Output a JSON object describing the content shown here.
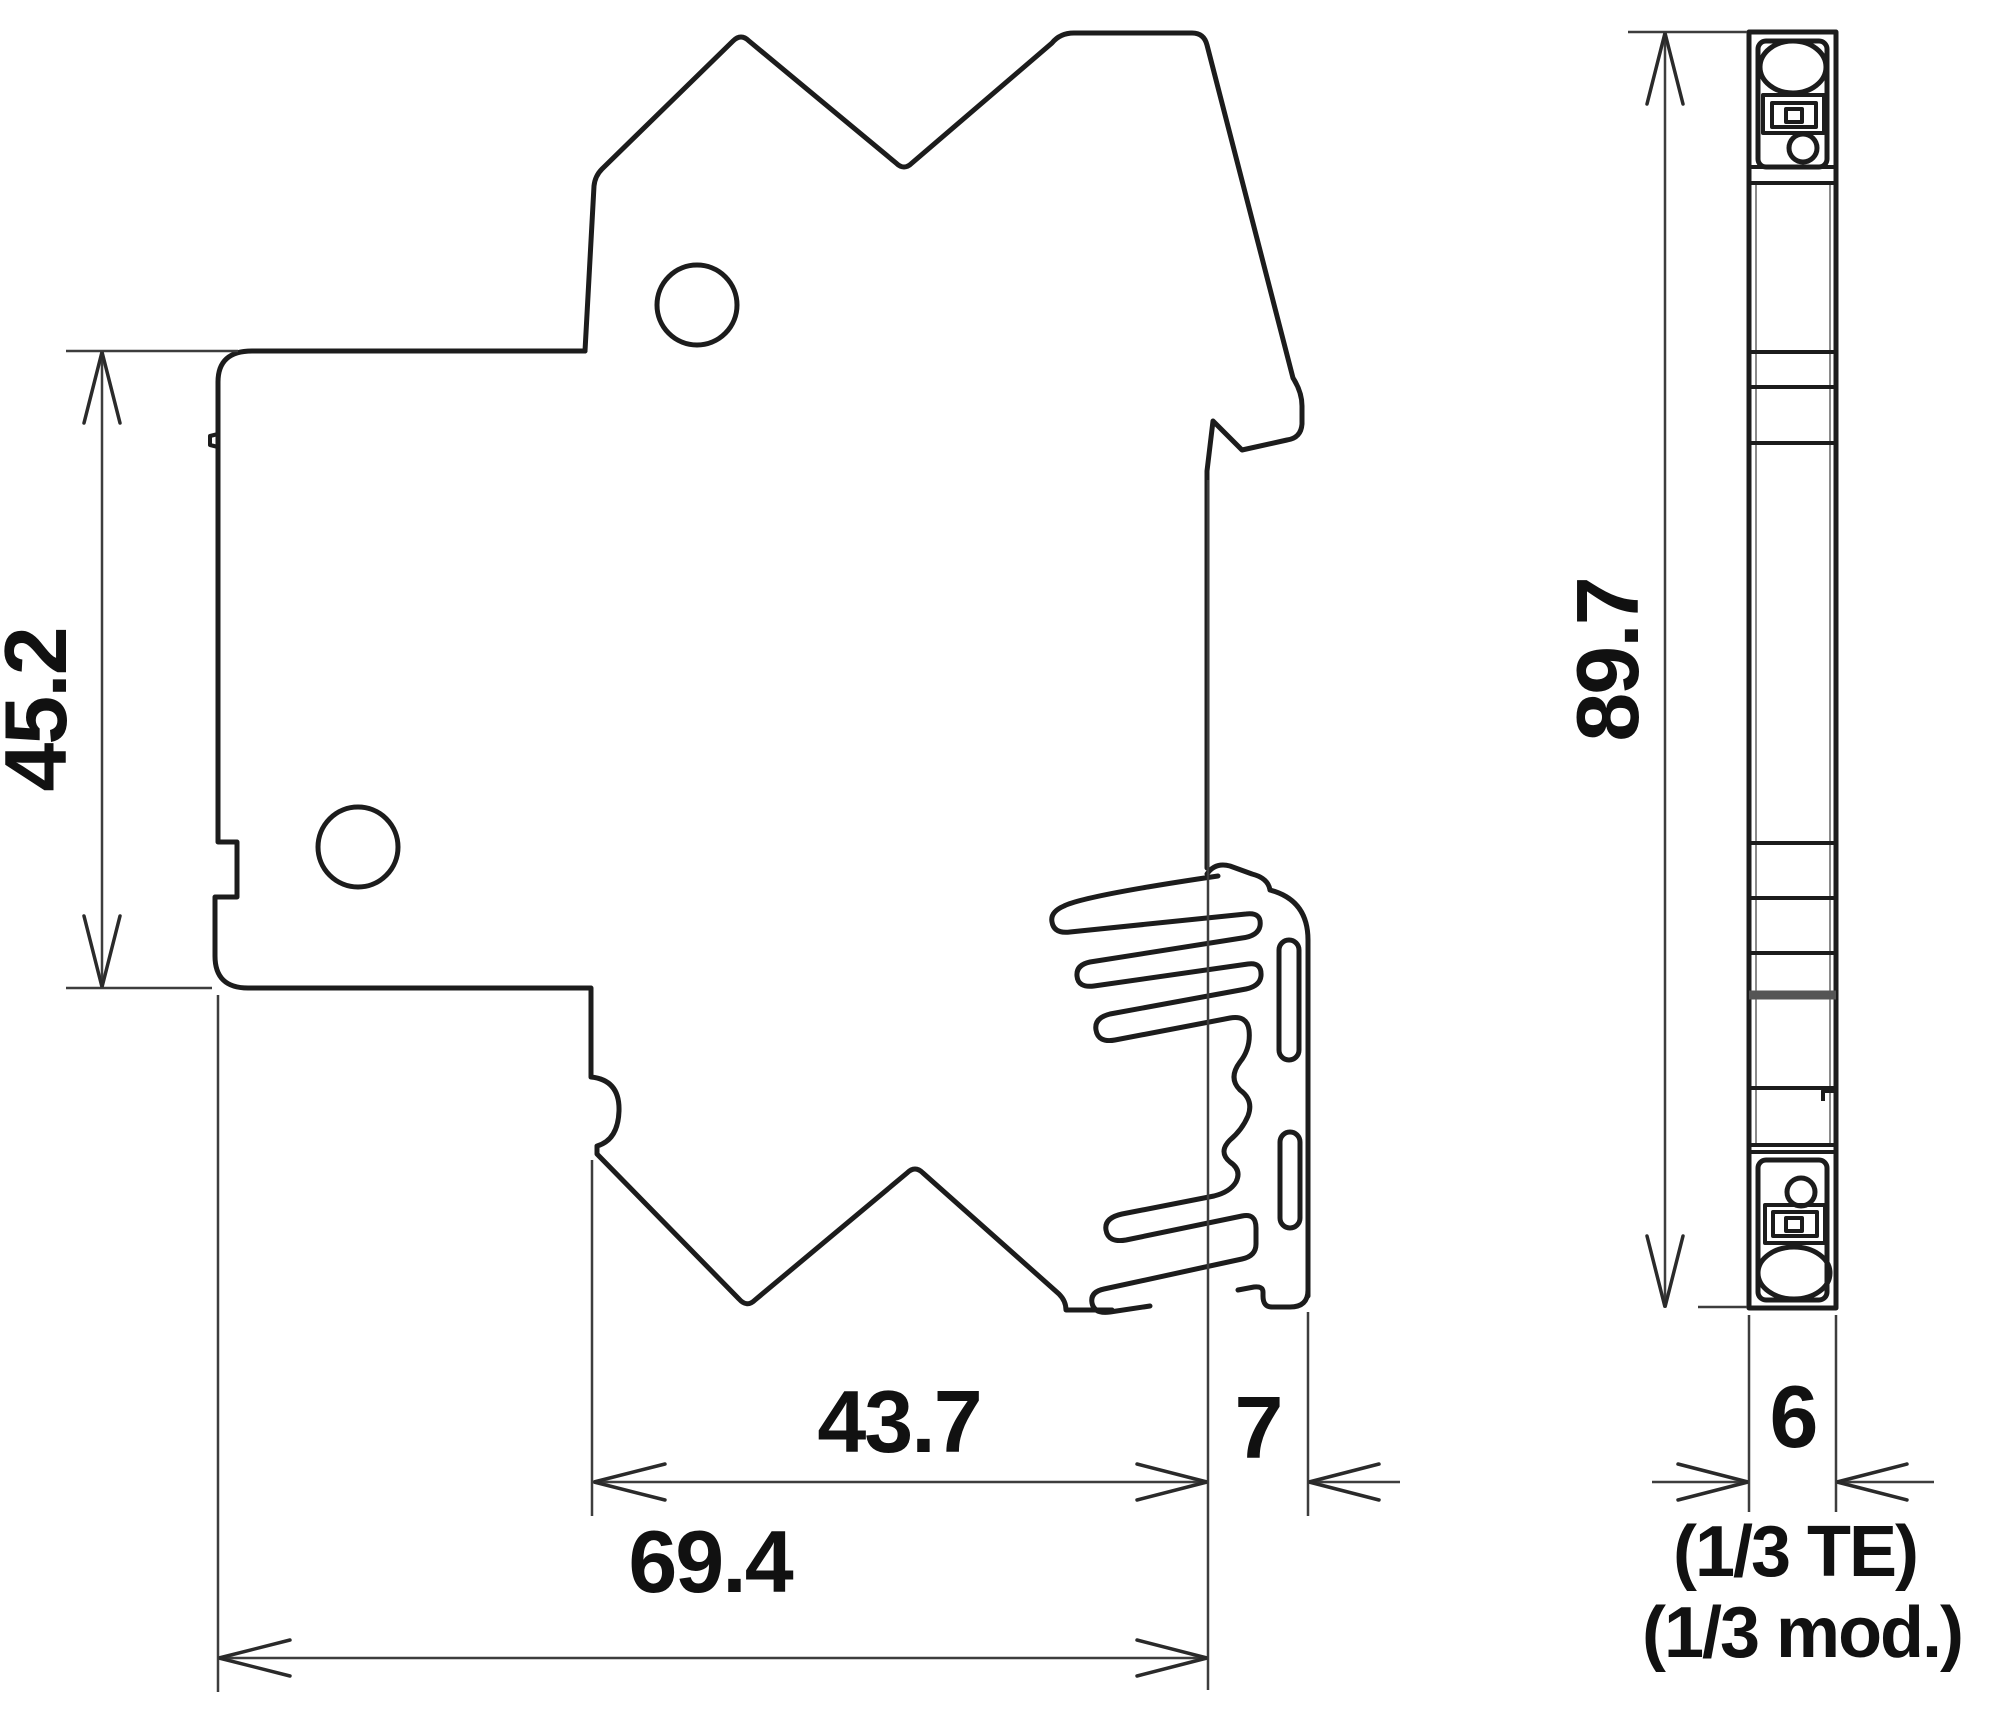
{
  "page": {
    "background": "#ffffff",
    "line_color": "#1c1c1c",
    "dimension_line_color": "#3d3d3d",
    "text_color": "#111111"
  },
  "drawing": {
    "type": "technical-dimension-drawing",
    "views": [
      {
        "id": "side-view",
        "description": "side profile of DIN-rail module with mounting clip"
      },
      {
        "id": "front-view",
        "description": "narrow front/edge profile with screw terminals"
      }
    ],
    "dimensions": {
      "upper_left_height": {
        "label": "45.2"
      },
      "overall_height": {
        "label": "89.7"
      },
      "body_depth": {
        "label": "43.7"
      },
      "clip_depth": {
        "label": "7"
      },
      "total_depth": {
        "label": "69.4"
      },
      "module_width": {
        "label": "6"
      },
      "module_width_note_te": {
        "label": "(1/3 TE)"
      },
      "module_width_note_mod": {
        "label": "(1/3 mod.)"
      }
    }
  }
}
